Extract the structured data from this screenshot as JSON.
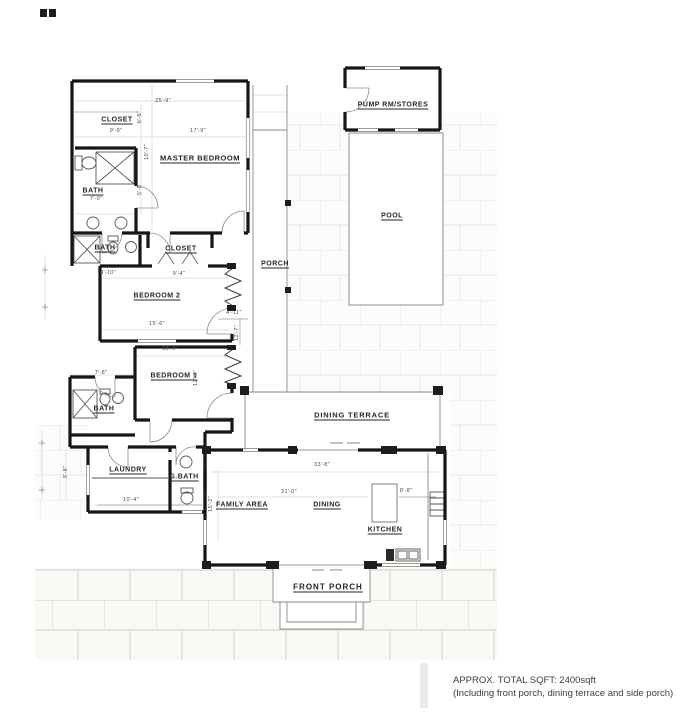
{
  "plan": {
    "rooms": [
      {
        "id": "closet-master",
        "label": "CLOSET",
        "x": 117,
        "y": 120
      },
      {
        "id": "master-bedroom",
        "label": "MASTER BEDROOM",
        "x": 200,
        "y": 158
      },
      {
        "id": "bath-master",
        "label": "BATH",
        "x": 93,
        "y": 191
      },
      {
        "id": "bath-2",
        "label": "BATH",
        "x": 105,
        "y": 248
      },
      {
        "id": "closet-2",
        "label": "CLOSET",
        "x": 181,
        "y": 249
      },
      {
        "id": "bedroom-2",
        "label": "BEDROOM 2",
        "x": 157,
        "y": 296
      },
      {
        "id": "porch",
        "label": "PORCH",
        "x": 275,
        "y": 264
      },
      {
        "id": "bedroom-1",
        "label": "BEDROOM 1",
        "x": 174,
        "y": 376
      },
      {
        "id": "bath-1",
        "label": "BATH",
        "x": 104,
        "y": 409
      },
      {
        "id": "laundry",
        "label": "LAUNDRY",
        "x": 128,
        "y": 470
      },
      {
        "id": "g-bath",
        "label": "G.BATH",
        "x": 184,
        "y": 477
      },
      {
        "id": "pump-room",
        "label": "PUMP RM/STORES",
        "x": 393,
        "y": 105
      },
      {
        "id": "pool",
        "label": "POOL",
        "x": 392,
        "y": 216
      },
      {
        "id": "dining-terrace",
        "label": "DINING TERRACE",
        "x": 352,
        "y": 415
      },
      {
        "id": "family-area",
        "label": "FAMILY AREA",
        "x": 242,
        "y": 505
      },
      {
        "id": "dining",
        "label": "DINING",
        "x": 327,
        "y": 505
      },
      {
        "id": "kitchen",
        "label": "KITCHEN",
        "x": 385,
        "y": 530
      },
      {
        "id": "front-porch",
        "label": "FRONT PORCH",
        "x": 328,
        "y": 587
      }
    ],
    "dimensions": [
      {
        "text": "25'-9\"",
        "x": 163,
        "y": 101
      },
      {
        "text": "9'-9\"",
        "x": 116,
        "y": 131
      },
      {
        "text": "17'-9\"",
        "x": 198,
        "y": 131
      },
      {
        "text": "6'-6\"",
        "x": 140,
        "y": 117,
        "rot": 1
      },
      {
        "text": "10'-7\"",
        "x": 147,
        "y": 152,
        "rot": 1
      },
      {
        "text": "5'-8\"",
        "x": 140,
        "y": 189,
        "rot": 1
      },
      {
        "text": "7'-0\"",
        "x": 96,
        "y": 199
      },
      {
        "text": "4'-10\"",
        "x": 108,
        "y": 273
      },
      {
        "text": "9'-4\"",
        "x": 179,
        "y": 274
      },
      {
        "text": "15'-6\"",
        "x": 157,
        "y": 324
      },
      {
        "text": "4'-11\"",
        "x": 234,
        "y": 313
      },
      {
        "text": "12'-7\"",
        "x": 237,
        "y": 333,
        "rot": 1
      },
      {
        "text": "13'-9\"",
        "x": 170,
        "y": 349
      },
      {
        "text": "12'-0\"",
        "x": 196,
        "y": 378,
        "rot": 1
      },
      {
        "text": "7'-8\"",
        "x": 101,
        "y": 373
      },
      {
        "text": "10'-4\"",
        "x": 131,
        "y": 500
      },
      {
        "text": "5'-8\"",
        "x": 66,
        "y": 472,
        "rot": 1
      },
      {
        "text": "15'-2\"",
        "x": 211,
        "y": 504,
        "rot": 1
      },
      {
        "text": "33'-8\"",
        "x": 322,
        "y": 465
      },
      {
        "text": "21'-0\"",
        "x": 289,
        "y": 492
      },
      {
        "text": "8'-8\"",
        "x": 406,
        "y": 491
      }
    ],
    "notes": {
      "line1": "APPROX. TOTAL SQFT: 2400sqft",
      "line2": "(Including front porch, dining terrace and side porch)"
    }
  },
  "colors": {
    "wall": "#161616",
    "fixture_line": "#555555",
    "light_line": "#d6d6d1",
    "paver_line": "#e2e2dd",
    "text": "#3d3d3d"
  }
}
